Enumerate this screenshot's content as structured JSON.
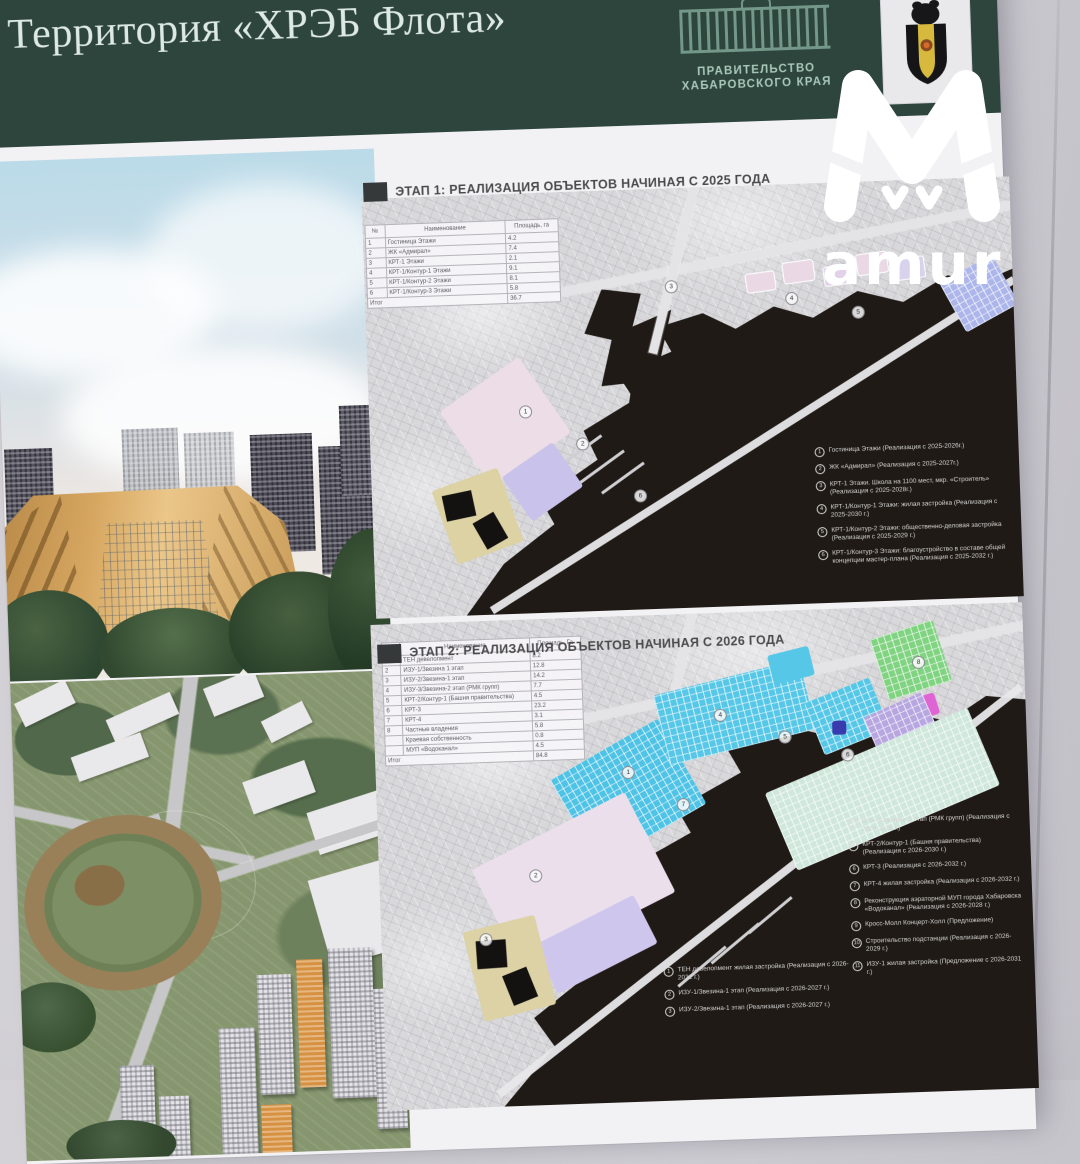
{
  "watermark": {
    "text": "amur",
    "color": "#ffffff"
  },
  "header": {
    "title": "Территория «ХРЭБ Флота»",
    "gov_line1": "ПРАВИТЕЛЬСТВО",
    "gov_line2": "ХАБАРОВСКОГО КРАЯ",
    "band_color": "#2c453d"
  },
  "stage1": {
    "title": "ЭТАП 1: РЕАЛИЗАЦИЯ ОБЪЕКТОВ НАЧИНАЯ С 2025 ГОДА",
    "table": {
      "headers": [
        "№",
        "Наименование",
        "Площадь, га"
      ],
      "rows": [
        [
          "1",
          "Гостиница Этажи",
          "4.2"
        ],
        [
          "2",
          "ЖК «Адмирал»",
          "7.4"
        ],
        [
          "3",
          "КРТ-1 Этажи",
          "2.1"
        ],
        [
          "4",
          "КРТ-1/Контур-1 Этажи",
          "9.1"
        ],
        [
          "5",
          "КРТ-1/Контур-2 Этажи",
          "8.1"
        ],
        [
          "6",
          "КРТ-1/Контур-3 Этажи",
          "5.8"
        ]
      ],
      "total_label": "Итог",
      "total_value": "36.7"
    },
    "legend": [
      {
        "n": "1",
        "t": "Гостиница Этажи (Реализация с 2025-2026г.)"
      },
      {
        "n": "2",
        "t": "ЖК «Адмирал» (Реализация с 2025-2027г.)"
      },
      {
        "n": "3",
        "t": "КРТ-1 Этажи. Школа на 1100 мест, мкр. «Строитель» (Реализация с 2025-2028г.)"
      },
      {
        "n": "4",
        "t": "КРТ-1/Контур-1 Этажи: жилая застройка (Реализация с 2025-2030 г.)"
      },
      {
        "n": "5",
        "t": "КРТ-1/Контур-2 Этажи: общественно-деловая застройка (Реализация с 2025-2029 г.)"
      },
      {
        "n": "6",
        "t": "КРТ-1/Контур-3 Этажи: благоустройство в составе общей концепции мастер-плана (Реализация с 2025-2032 г.)"
      }
    ],
    "map_markers": [
      "1",
      "2",
      "3",
      "4",
      "5",
      "6"
    ]
  },
  "stage2": {
    "title": "ЭТАП 2: РЕАЛИЗАЦИЯ ОБЪЕКТОВ НАЧИНАЯ С 2026 ГОДА",
    "table": {
      "headers": [
        "№",
        "Наименование",
        "Площадь, Га"
      ],
      "rows": [
        [
          "1",
          "ТЕН девелопмент",
          "8.2"
        ],
        [
          "2",
          "ИЗУ-1/Звезина 1 этап",
          "12.8"
        ],
        [
          "3",
          "ИЗУ-2/Звезина-1 этап",
          "14.2"
        ],
        [
          "4",
          "ИЗУ-3/Звезина-2 этап (РМК групп)",
          "7.7"
        ],
        [
          "5",
          "КРТ-2/Контур-1 (Башня правительства)",
          "4.5"
        ],
        [
          "6",
          "КРТ-3",
          "23.2"
        ],
        [
          "7",
          "КРТ-4",
          "3.1"
        ],
        [
          "8",
          "Частные владения",
          "5.8"
        ],
        [
          "",
          "Краевая собственность",
          "0.8"
        ],
        [
          "",
          "МУП «Водоканал»",
          "4.5"
        ]
      ],
      "total_label": "Итог",
      "total_value": "84.8"
    },
    "legend_left": [
      {
        "n": "1",
        "t": "ТЕН девелопмент жилая застройка (Реализация с 2026-2032 г.)"
      },
      {
        "n": "2",
        "t": "ИЗУ-1/Звезина-1 этап (Реализация с 2026-2027 г.)"
      },
      {
        "n": "3",
        "t": "ИЗУ-2/Звезина-1 этап (Реализация с 2026-2027 г.)"
      }
    ],
    "legend_right": [
      {
        "n": "4",
        "t": "ИЗУ-3/Звезина 2 этап (РМК групп) (Реализация с 2026-2028 г.)"
      },
      {
        "n": "5",
        "t": "КРТ-2/Контур-1 (Башня правительства) (Реализация с 2026-2030 г.)"
      },
      {
        "n": "6",
        "t": "КРТ-3 (Реализация с 2026-2032 г.)"
      },
      {
        "n": "7",
        "t": "КРТ-4 жилая застройка (Реализация с 2026-2032 г.)"
      },
      {
        "n": "8",
        "t": "Реконструкция аэраторной МУП города Хабаровска «Водоканал» (Реализация с 2026-2028 г.)"
      },
      {
        "n": "9",
        "t": "Кросс-Молл Концерт-Холл (Предложение)"
      },
      {
        "n": "10",
        "t": "Строительство подстанции (Реализация с 2026-2029 г.)"
      },
      {
        "n": "11",
        "t": "ИЗУ-1 жилая застройка (Предложение с 2026-2031 г.)"
      }
    ],
    "map_markers": [
      "1",
      "2",
      "3",
      "4",
      "5",
      "6",
      "7",
      "8"
    ]
  },
  "colors": {
    "header_green": "#2c453d",
    "paper": "#f2f1f4",
    "map_land": "#d8d7da",
    "river_dark": "#201a16",
    "parcel_pink": "#ecdde6",
    "parcel_lavender": "#c9c2ec",
    "parcel_beige": "#dcd2a2",
    "parcel_blue": "#acb6ec",
    "parcel_cyan": "#4fc6e8",
    "parcel_green": "#7ed47f",
    "parcel_magenta": "#e263d6",
    "parcel_purple": "#b7a6e2",
    "watermark_white": "#ffffff"
  }
}
